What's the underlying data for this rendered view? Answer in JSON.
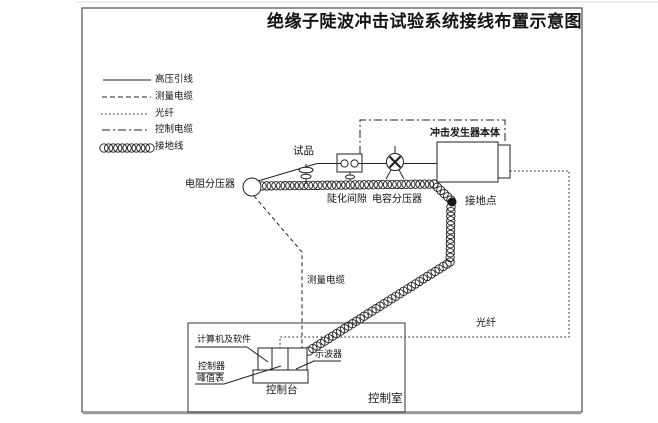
{
  "title": "绝缘子陡波冲击试验系统接线布置示意图",
  "legend": {
    "items": [
      {
        "style": "solid",
        "label": "高压引线"
      },
      {
        "style": "dashed",
        "label": "测量电缆"
      },
      {
        "style": "dotted",
        "label": "光纤"
      },
      {
        "style": "dashdot",
        "label": "控制电缆"
      },
      {
        "style": "coil",
        "label": "接地线"
      }
    ]
  },
  "labels": {
    "resistive_divider": "电阻分压器",
    "test_object": "试品",
    "measurement_cable": "测量电缆",
    "steepening_gap": "陡化间隙",
    "capacitive_divider": "电容分压器",
    "impulse_generator_body": "冲击发生器本体",
    "ground_point": "接地点",
    "optical_fiber": "光纤",
    "computer_and_software": "计算机及软件",
    "controller": "控制器",
    "peak_meter": "峰值表",
    "oscilloscope": "示波器",
    "control_console": "控制台",
    "control_room": "控制室"
  },
  "colors": {
    "ink": "#222222",
    "background": "#ffffff",
    "frame": "#4a4a4a",
    "frame_bottom": "#9a9a9a"
  }
}
